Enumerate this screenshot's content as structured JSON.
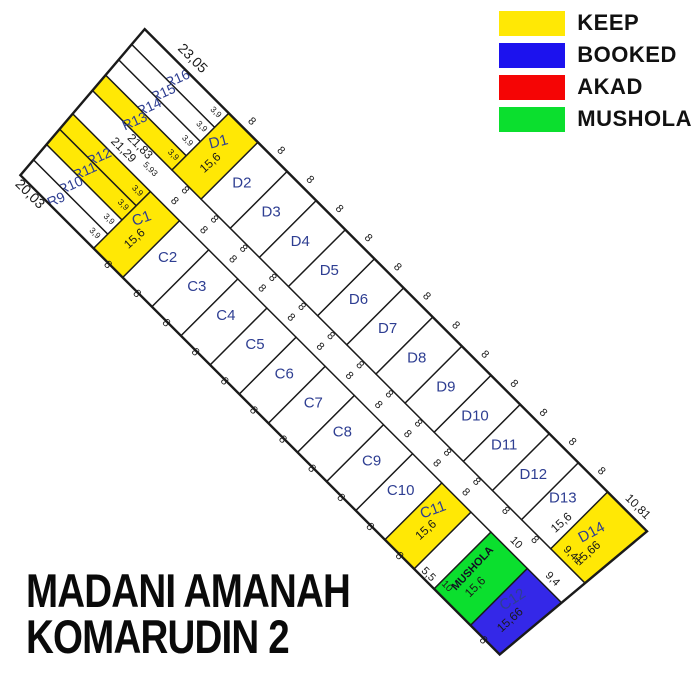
{
  "title": {
    "line1": "MADANI AMANAH",
    "line2": "KOMARUDIN 2"
  },
  "legend": {
    "items": [
      {
        "label": "KEEP",
        "status": "keep",
        "color": "#ffe805"
      },
      {
        "label": "BOOKED",
        "status": "booked",
        "color": "#1c12ee"
      },
      {
        "label": "AKAD",
        "status": "akad",
        "color": "#f50505"
      },
      {
        "label": "MUSHOLA",
        "status": "mushola",
        "color": "#0bdf2e"
      }
    ]
  },
  "map": {
    "colors": {
      "keep": "#ffe805",
      "booked": "#3428e8",
      "akad": "#f50505",
      "mushola": "#0bdf2e",
      "available": "#ffffff",
      "road": "#ffffff",
      "line": "#1a1a1a",
      "name_text": "#2e3e92",
      "dim_text": "#1a1a1a"
    },
    "d_row": {
      "plots": [
        {
          "id": "D1",
          "status": "keep",
          "w": 8,
          "top": "8",
          "bottom": "8",
          "len": "15,6"
        },
        {
          "id": "D2",
          "status": "available",
          "w": 8,
          "top": "8",
          "bottom": "8"
        },
        {
          "id": "D3",
          "status": "available",
          "w": 8,
          "top": "8",
          "bottom": "8"
        },
        {
          "id": "D4",
          "status": "available",
          "w": 8,
          "top": "8",
          "bottom": "8"
        },
        {
          "id": "D5",
          "status": "available",
          "w": 8,
          "top": "8",
          "bottom": "8"
        },
        {
          "id": "D6",
          "status": "available",
          "w": 8,
          "top": "8",
          "bottom": "8"
        },
        {
          "id": "D7",
          "status": "available",
          "w": 8,
          "top": "8",
          "bottom": "8"
        },
        {
          "id": "D8",
          "status": "available",
          "w": 8,
          "top": "8",
          "bottom": "8"
        },
        {
          "id": "D9",
          "status": "available",
          "w": 8,
          "top": "8",
          "bottom": "8"
        },
        {
          "id": "D10",
          "status": "available",
          "w": 8,
          "top": "8",
          "bottom": "8"
        },
        {
          "id": "D11",
          "status": "available",
          "w": 8,
          "top": "8",
          "bottom": "8"
        },
        {
          "id": "D12",
          "status": "available",
          "w": 8,
          "top": "8",
          "bottom": "8"
        },
        {
          "id": "D13",
          "status": "available",
          "w": 8,
          "top": "8",
          "bottom": "8",
          "len": "15,6"
        },
        {
          "id": "D14",
          "status": "keep",
          "w_top": 10.81,
          "w_bottom": 9.41,
          "top": "10,81",
          "bottom": "9,41",
          "len": "15,66"
        }
      ]
    },
    "c_row": {
      "items": [
        {
          "type": "plot",
          "id": "C1",
          "status": "keep",
          "w": 8,
          "top": "8",
          "bottom": "8",
          "len": "15,6"
        },
        {
          "type": "plot",
          "id": "C2",
          "status": "available",
          "w": 8,
          "top": "8",
          "bottom": "8"
        },
        {
          "type": "plot",
          "id": "C3",
          "status": "available",
          "w": 8,
          "top": "8",
          "bottom": "8"
        },
        {
          "type": "plot",
          "id": "C4",
          "status": "available",
          "w": 8,
          "top": "8",
          "bottom": "8"
        },
        {
          "type": "plot",
          "id": "C5",
          "status": "available",
          "w": 8,
          "top": "8",
          "bottom": "8"
        },
        {
          "type": "plot",
          "id": "C6",
          "status": "available",
          "w": 8,
          "top": "8",
          "bottom": "8"
        },
        {
          "type": "plot",
          "id": "C7",
          "status": "available",
          "w": 8,
          "top": "8",
          "bottom": "8"
        },
        {
          "type": "plot",
          "id": "C8",
          "status": "available",
          "w": 8,
          "top": "8",
          "bottom": "8"
        },
        {
          "type": "plot",
          "id": "C9",
          "status": "available",
          "w": 8,
          "top": "8",
          "bottom": "8"
        },
        {
          "type": "plot",
          "id": "C10",
          "status": "available",
          "w": 8,
          "top": "8",
          "bottom": "8"
        },
        {
          "type": "plot",
          "id": "C11",
          "status": "keep",
          "w": 8,
          "top": "8",
          "bottom": "8",
          "len": "15,6"
        },
        {
          "type": "gap",
          "w": 5.5,
          "label": "5,5"
        },
        {
          "type": "plot",
          "id": "MUSHOLA",
          "status": "mushola",
          "w": 10,
          "top": "10",
          "bottom": "10",
          "len": "15,6"
        },
        {
          "type": "plot",
          "id": "C12",
          "status": "booked",
          "w_top": 9.4,
          "w_bottom": 8,
          "top": "9,4",
          "bottom": "8",
          "len": "15,66"
        }
      ]
    },
    "r_block": {
      "strips": [
        {
          "type": "plot",
          "id": "R16",
          "status": "available",
          "w": 3.9,
          "end": "3,9"
        },
        {
          "type": "plot",
          "id": "R15",
          "status": "available",
          "w": 3.9,
          "end": "3,9"
        },
        {
          "type": "plot",
          "id": "R14",
          "status": "available",
          "w": 3.9,
          "end": "3,9"
        },
        {
          "type": "plot",
          "id": "R13",
          "status": "keep",
          "w": 3.9,
          "end": "3,9"
        },
        {
          "type": "road",
          "w": 5.93,
          "end": "5,93",
          "top_len": "21,83",
          "bottom_len": "21,29"
        },
        {
          "type": "plot",
          "id": "R12",
          "status": "keep",
          "w": 3.9,
          "end": "3,9"
        },
        {
          "type": "plot",
          "id": "R11",
          "status": "keep",
          "w": 3.9,
          "end": "3,9"
        },
        {
          "type": "plot",
          "id": "R10",
          "status": "available",
          "w": 3.9,
          "end": "3,9"
        },
        {
          "type": "plot",
          "id": "R9",
          "status": "available",
          "w": 3.9,
          "end": "3,9"
        }
      ],
      "top_edge_label": "23,05",
      "bottom_edge_label": "20,03"
    }
  }
}
